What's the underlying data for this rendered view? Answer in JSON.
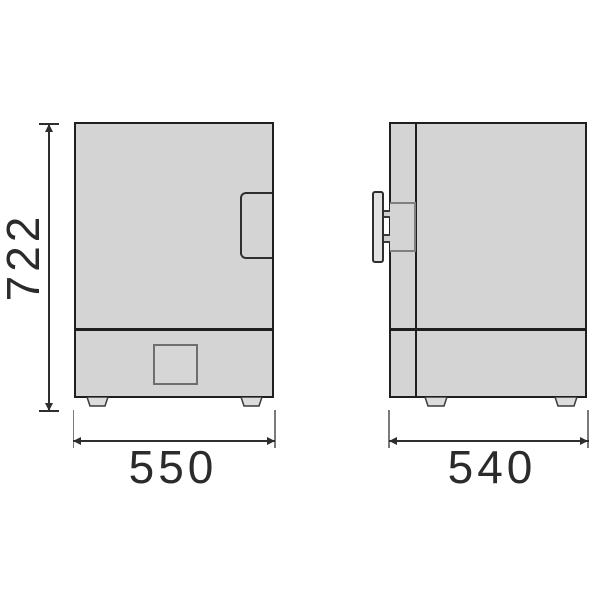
{
  "title": "appliance-dimension-drawing",
  "views": {
    "front": {
      "name": "front-view"
    },
    "side": {
      "name": "side-view"
    }
  },
  "dimensions": {
    "height": "722",
    "width": "550",
    "depth": "540"
  },
  "colors": {
    "body_fill": "#d4d4d4",
    "outline": "#1f1f1f",
    "dimension_line": "#2e2e2e",
    "extension_line": "#7a7a7a",
    "background": "#ffffff"
  }
}
